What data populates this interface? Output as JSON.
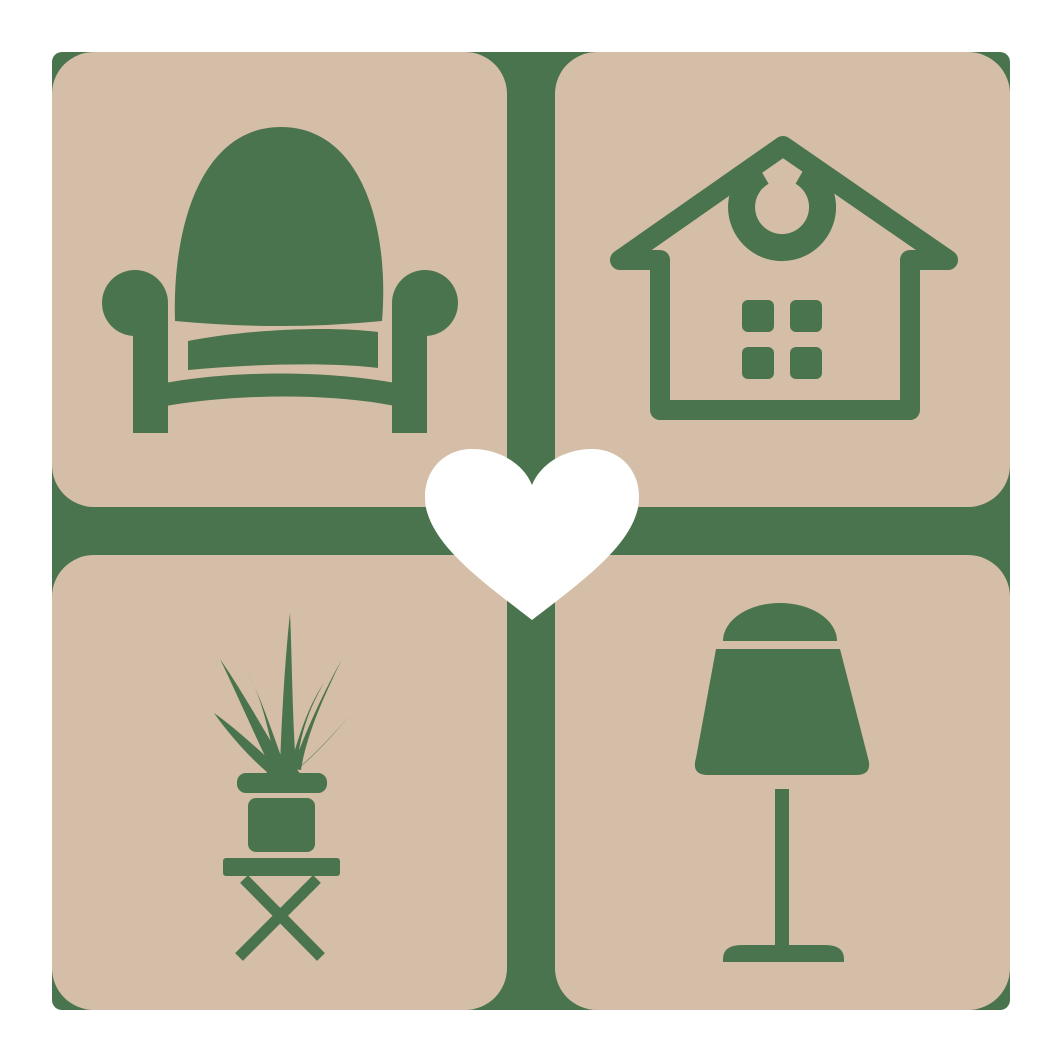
{
  "page": {
    "background_color": "#ffffff"
  },
  "logo": {
    "description": "home-decor logo: four tan rounded tiles with green furniture icons on a green backing cross, white heart at center",
    "colors": {
      "green": "#4a744d",
      "tan": "#d5bea7",
      "heart": "#ffffff",
      "page_bg": "#ffffff"
    },
    "tiles": [
      {
        "name": "armchair",
        "icon": "armchair-icon"
      },
      {
        "name": "house",
        "icon": "house-icon"
      },
      {
        "name": "potted-plant",
        "icon": "potted-plant-icon"
      },
      {
        "name": "table-lamp",
        "icon": "table-lamp-icon"
      }
    ],
    "center": {
      "icon": "heart-icon"
    }
  }
}
